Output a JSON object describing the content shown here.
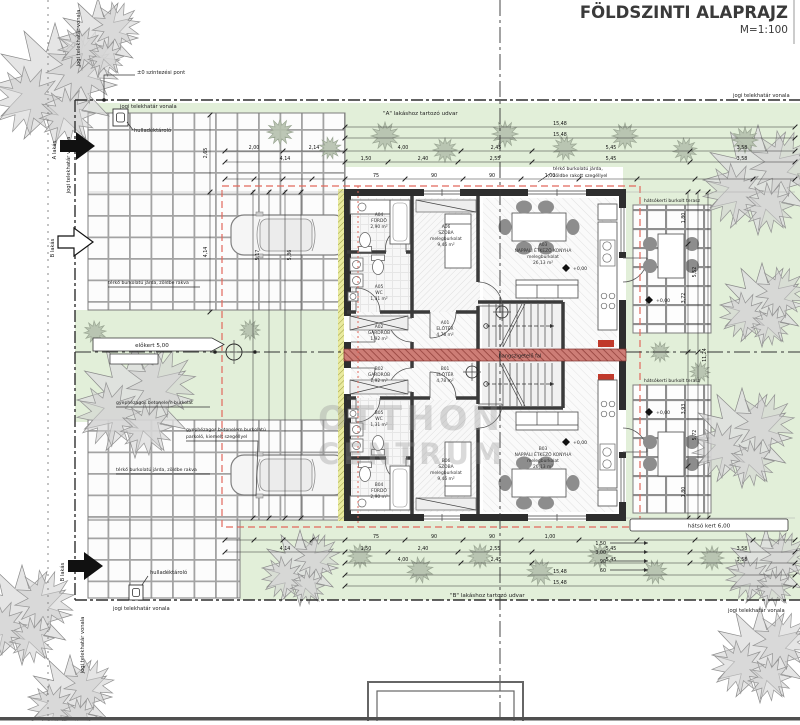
{
  "title": {
    "main": "FÖLDSZINTI ALAPRAJZ",
    "scale": "M=1:100"
  },
  "site": {
    "boundary": "jogi telekhatár vonala",
    "courtyard_a": "\"A\" lakáshoz tartozó udvar",
    "courtyard_b": "\"B\" lakáshoz tartozó udvar",
    "front_garden": "előkert 5,00",
    "rear_garden": "hátsó kert 6,00",
    "waste": "hulladéktároló",
    "level_point": "±0 szintezési pont",
    "walkway": "térkő burkolatú járda, zöldbe rakva",
    "walkway2": "térkő burkolatú járda,",
    "walkway2b": "zöldbe rakott szegéllyel",
    "parking1": "gyephézagos betonelem burkolatú",
    "parking2": "parkoló, kiemelt szegéllyel",
    "parking3": "gyephézagos betonelem burkolat",
    "terrace": "hátsókerti burkolt terasz",
    "apt_a": "A lakás",
    "apt_b": "B lakás",
    "acoustic_wall": "hangszigetelő fal",
    "level_zero": "+0,00"
  },
  "rooms": {
    "a01": {
      "id": "A01",
      "name": "ELŐTÉR",
      "area": "4,78 m²"
    },
    "a02": {
      "id": "A02",
      "name": "GARDRÓB",
      "area": "1,92 m²"
    },
    "a03": {
      "id": "A03",
      "name": "NAPPALI ÉTKEZŐ KONYHA",
      "note": "melegburkolat",
      "area": "26,13 m²"
    },
    "a04": {
      "id": "A04",
      "name": "FÜRDŐ",
      "area": "2,90 m²"
    },
    "a05": {
      "id": "A05",
      "name": "WC",
      "area": "1,31 m²"
    },
    "a06": {
      "id": "A06",
      "name": "SZOBA",
      "note": "melegburkolat",
      "area": "9,46 m²"
    },
    "b01": {
      "id": "B01",
      "name": "ELŐTÉR",
      "area": "4,78 m²"
    },
    "b02": {
      "id": "B02",
      "name": "GARDRÓB",
      "area": "1,92 m²"
    },
    "b03": {
      "id": "B03",
      "name": "NAPPALI ÉTKEZŐ KONYHA",
      "note": "melegburkolat",
      "area": "26,13 m²"
    },
    "b04": {
      "id": "B04",
      "name": "FÜRDŐ",
      "area": "2,90 m²"
    },
    "b05": {
      "id": "B05",
      "name": "WC",
      "area": "1,31 m²"
    },
    "b06": {
      "id": "B06",
      "name": "SZOBA",
      "note": "melegburkolat",
      "area": "9,46 m²"
    }
  },
  "dims": {
    "top_total1": "15,48",
    "top_total2": "15,48",
    "row3": [
      "4,00",
      "2,45",
      "5,45",
      "3,58"
    ],
    "row4": [
      "1,50",
      "2,40",
      "2,55",
      "5,45",
      "3,58"
    ],
    "left3": [
      "2,00",
      "2,14"
    ],
    "left4": "4,14",
    "fine": [
      "75",
      "90",
      "90",
      "1,00"
    ],
    "bottom_total1": "15,48",
    "bottom_total2": "15,48",
    "right1": [
      "1,80",
      "3,72",
      "3,93",
      "1,80"
    ],
    "right2": [
      "5,52",
      "5,72"
    ],
    "right3": "11,24",
    "leftcol": [
      "2,65",
      "4,14"
    ],
    "parking": [
      "5,17",
      "5,36"
    ],
    "garden": [
      "1,50",
      "3,00",
      "90",
      "60"
    ]
  },
  "watermark": {
    "l1": "OTTHON",
    "l2": "CENTRUM"
  }
}
